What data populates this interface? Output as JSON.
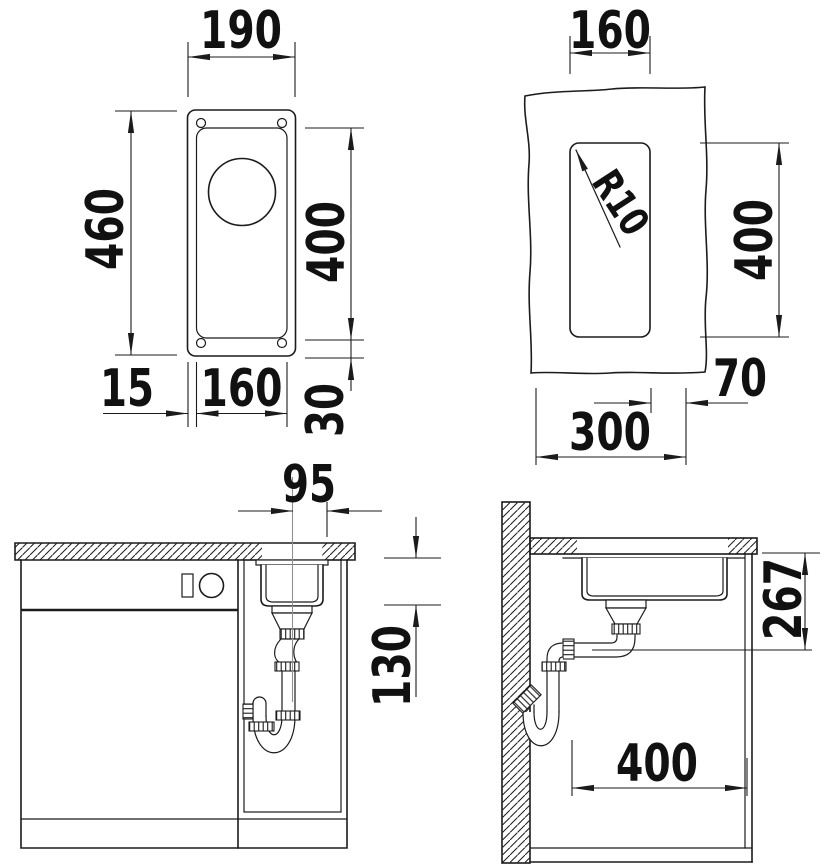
{
  "drawing": {
    "title": "sink-installation-drawing",
    "top_view": {
      "overall_width": "190",
      "overall_length": "460",
      "bowl_length": "400",
      "edge_offset": "15",
      "bowl_width": "160",
      "end_offset": "30"
    },
    "cutout_view": {
      "cutout_width": "160",
      "corner_radius": "R10",
      "cutout_length": "400",
      "side_offset": "70",
      "cabinet_width": "300"
    },
    "front_view": {
      "center_to_edge": "95",
      "bowl_depth": "130"
    },
    "side_view": {
      "drain_height": "267",
      "cabinet_depth": "400"
    }
  },
  "colors": {
    "line": "#1b1b1b",
    "centerline": "#8f8f8f",
    "background": "#ffffff"
  }
}
